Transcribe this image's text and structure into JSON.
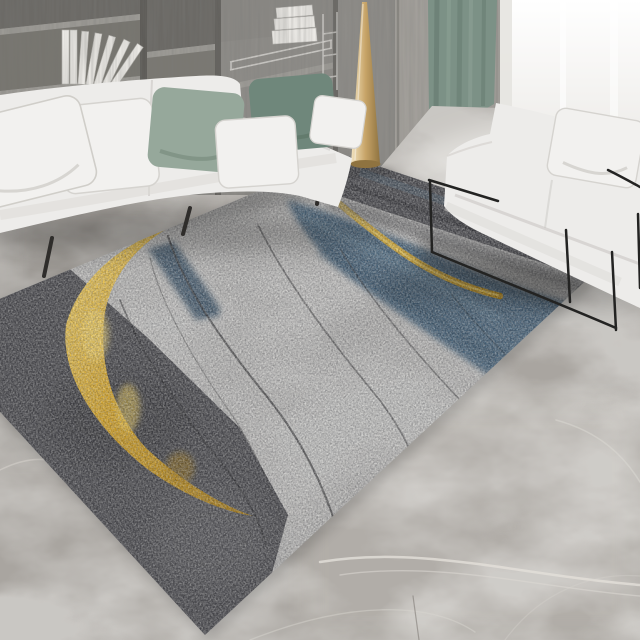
{
  "scene": {
    "description": "Modern living room product photo: abstract gray, gold and blue area rug on a marble floor between two white sofas",
    "objects": [
      "bookshelf",
      "books",
      "left-sofa",
      "right-sofa",
      "throw-pillows",
      "green-curtain",
      "window",
      "gold-cone-decor",
      "area-rug",
      "marble-floor"
    ]
  },
  "colors": {
    "sofa_white": "#edecea",
    "sofa_crease": "#c9c7c3",
    "pillow_white": "#f2f1ef",
    "pillow_sage": "#96a89b",
    "pillow_teal": "#6f877b",
    "shelf_wood": "#8e8c88",
    "shelf_recess": "#6b6965",
    "shelf_board": "#9d9b96",
    "wall_panel": "#a29f9a",
    "curtain_green": "#7c9186",
    "window_white": "#f4f3f1",
    "cone_gold": "#c7a468",
    "floor_marble": "#a9a5a0",
    "vein_white": "#e2dfda",
    "rug_field": "#b5b4b2",
    "rug_dark": "#46464a",
    "rug_gold": "#d7a31f",
    "rug_gold_bright": "#f3cf57",
    "rug_blue": "#47637a",
    "rug_blue_dark": "#3a5368",
    "rug_line": "#2c2c2e",
    "metal_black": "#232322",
    "book_white": "#eceae6"
  }
}
